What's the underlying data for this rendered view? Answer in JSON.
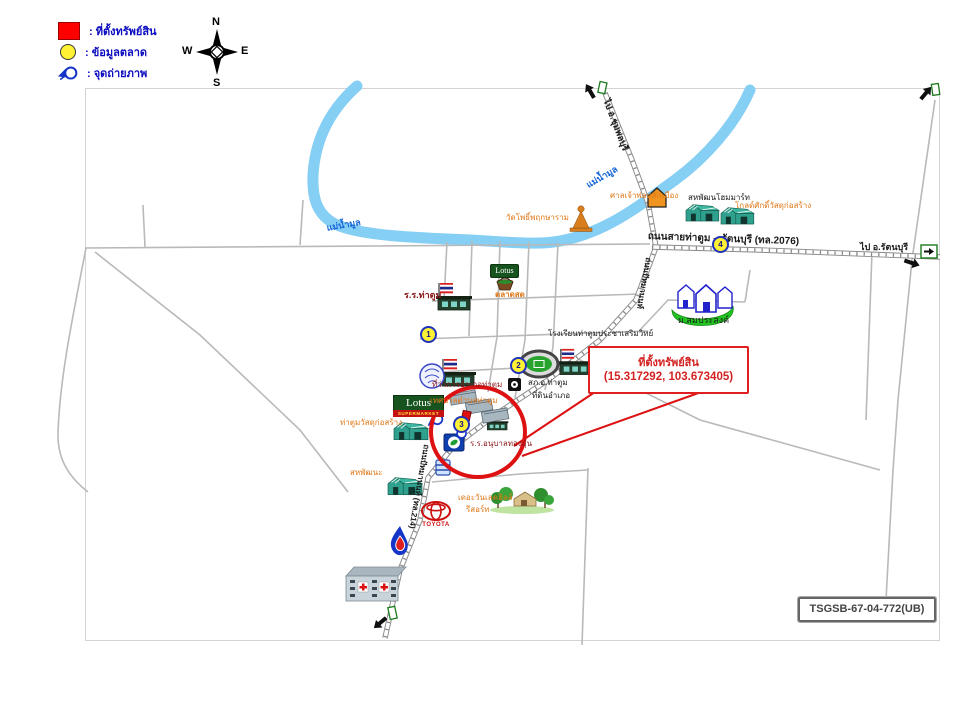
{
  "colors": {
    "black": "#1a1a1a",
    "orange": "#e07818",
    "blue": "#1565d8",
    "darkred": "#8b1a1a",
    "navy": "#0b0bc0",
    "accent_red": "#e02020",
    "river": "#85cef4",
    "road": "#b9b9b9",
    "marker_fill": "#fff235",
    "marker_border": "#2233bb"
  },
  "legend": {
    "items": [
      {
        "symbol": "property-square",
        "label": ": ที่ตั้งทรัพย์สิน"
      },
      {
        "symbol": "market-circle",
        "label": ": ข้อมูลตลาด"
      },
      {
        "symbol": "camera",
        "label": ": จุดถ่ายภาพ"
      }
    ]
  },
  "compass": {
    "n": "N",
    "w": "W",
    "e": "E",
    "s": "S"
  },
  "callout": {
    "title": "ที่ตั้งทรัพย์สิน",
    "coords": "(15.317292, 103.673405)"
  },
  "ref_code": "TSGSB-67-04-772(UB)",
  "brands": {
    "lotus": "Lotus",
    "lotus_sub": "SUPERMARKET",
    "toyota": "TOYOTA"
  },
  "map": {
    "labels": [
      {
        "text": "วัดโพธิ์พฤกษาราม",
        "x": 506,
        "y": 214,
        "size": 8,
        "color": "orange"
      },
      {
        "text": "ศาลเจ้าพ่อหลักเมือง",
        "x": 610,
        "y": 192,
        "size": 8,
        "color": "orange"
      },
      {
        "text": "สหพัฒนโฮมมาร์ท",
        "x": 688,
        "y": 194,
        "size": 8,
        "color": "black"
      },
      {
        "text": "โกลด์ศักดิ์วัสดุก่อสร้าง",
        "x": 735,
        "y": 202,
        "size": 8,
        "color": "orange"
      },
      {
        "text": "ถนนสายท่าตูม – รัตนบุรี (ทล.2076)",
        "x": 648,
        "y": 232,
        "size": 10,
        "color": "black",
        "bold": true,
        "rotate": 2
      },
      {
        "text": "ไป อ.รัตนบุรี",
        "x": 860,
        "y": 243,
        "size": 9,
        "color": "black",
        "bold": true
      },
      {
        "text": "ไป อ.ชุมพลบุรี",
        "x": 610,
        "y": 98,
        "size": 9,
        "color": "black",
        "bold": true,
        "rotate": 69
      },
      {
        "text": "แม่น้ำมูล",
        "x": 326,
        "y": 224,
        "size": 9,
        "color": "blue",
        "bold": true,
        "rotate": -10
      },
      {
        "text": "แม่น้ำมูล",
        "x": 585,
        "y": 182,
        "size": 9,
        "color": "blue",
        "bold": true,
        "rotate": -30
      },
      {
        "text": "ร.ร.ท่าตูม",
        "x": 404,
        "y": 291,
        "size": 9,
        "color": "darkred",
        "bold": true
      },
      {
        "text": "ตลาดสด",
        "x": 495,
        "y": 291,
        "size": 8,
        "color": "orange",
        "bold": true
      },
      {
        "text": "โรงเรียนท่าตูมประชาเสริมวิทย์",
        "x": 548,
        "y": 330,
        "size": 8,
        "color": "black"
      },
      {
        "text": "ม.สมประสงค์",
        "x": 678,
        "y": 316,
        "size": 9,
        "color": "black"
      },
      {
        "text": "ที่ว่าการอำเภอท่าตูม",
        "x": 432,
        "y": 381,
        "size": 8,
        "color": "darkred"
      },
      {
        "text": "สภ.อ.ท่าตูม",
        "x": 528,
        "y": 379,
        "size": 8,
        "color": "black"
      },
      {
        "text": "ที่ดินอำเภอ",
        "x": 532,
        "y": 392,
        "size": 8,
        "color": "black"
      },
      {
        "text": "เทศบาลตำบลท่าตูม",
        "x": 430,
        "y": 397,
        "size": 8,
        "color": "orange"
      },
      {
        "text": "ร.ร.อนุบาลทองอุ่น",
        "x": 470,
        "y": 440,
        "size": 8,
        "color": "darkred"
      },
      {
        "text": "ท่าตูมวัสดุก่อสร้าง",
        "x": 340,
        "y": 419,
        "size": 8,
        "color": "orange"
      },
      {
        "text": "สหพัฒนะ",
        "x": 350,
        "y": 469,
        "size": 8,
        "color": "orange"
      },
      {
        "text": "เดอะวันเลคฮิลล์",
        "x": 458,
        "y": 494,
        "size": 8,
        "color": "orange"
      },
      {
        "text": "รีสอร์ท",
        "x": 466,
        "y": 506,
        "size": 8,
        "color": "orange"
      },
      {
        "text": "ถนนปัทมานนท์ (ทล.214)",
        "x": 430,
        "y": 445,
        "size": 8,
        "color": "black",
        "bold": true,
        "rotate": 100
      },
      {
        "text": "ถนนปัทมานนท์",
        "x": 652,
        "y": 258,
        "size": 8,
        "color": "black",
        "bold": true,
        "rotate": 100
      }
    ],
    "market_markers": [
      {
        "n": "1",
        "x": 420,
        "y": 326
      },
      {
        "n": "2",
        "x": 510,
        "y": 357
      },
      {
        "n": "3",
        "x": 453,
        "y": 416
      },
      {
        "n": "4",
        "x": 712,
        "y": 236
      }
    ]
  }
}
